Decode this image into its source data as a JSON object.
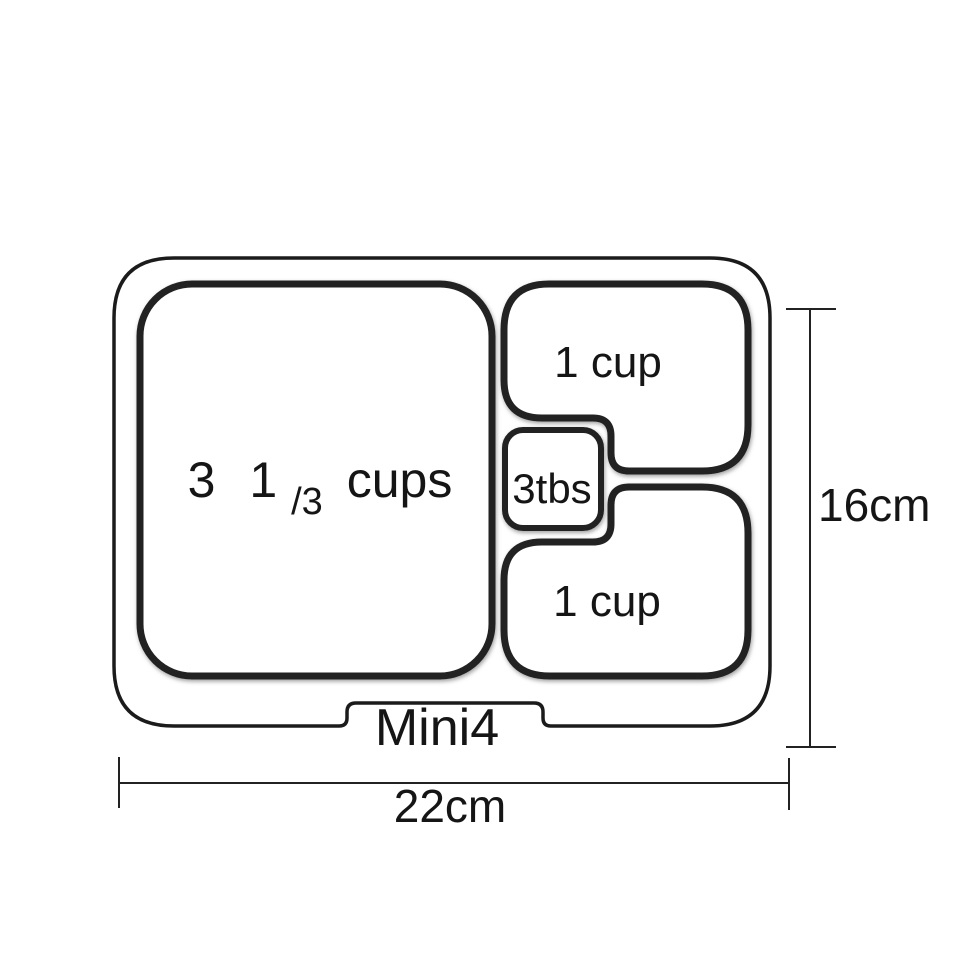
{
  "page": {
    "background": "#ffffff"
  },
  "diagram": {
    "model_label": "Mini4",
    "compartments": {
      "large": {
        "full_label": "3 1/3 cups",
        "whole": "3",
        "fraction_numerator": "1",
        "fraction_denominator": "/3",
        "unit": "cups"
      },
      "top_right": {
        "label": "1 cup"
      },
      "center_small": {
        "label": "3tbs"
      },
      "bottom_right": {
        "label": "1 cup"
      }
    },
    "dimensions": {
      "height_label": "16cm",
      "width_label": "22cm"
    },
    "colors": {
      "outline": "#1b1b1b",
      "compartment_stroke": "#232323",
      "shadow": "#909090",
      "text": "#151515",
      "background": "#ffffff"
    }
  }
}
